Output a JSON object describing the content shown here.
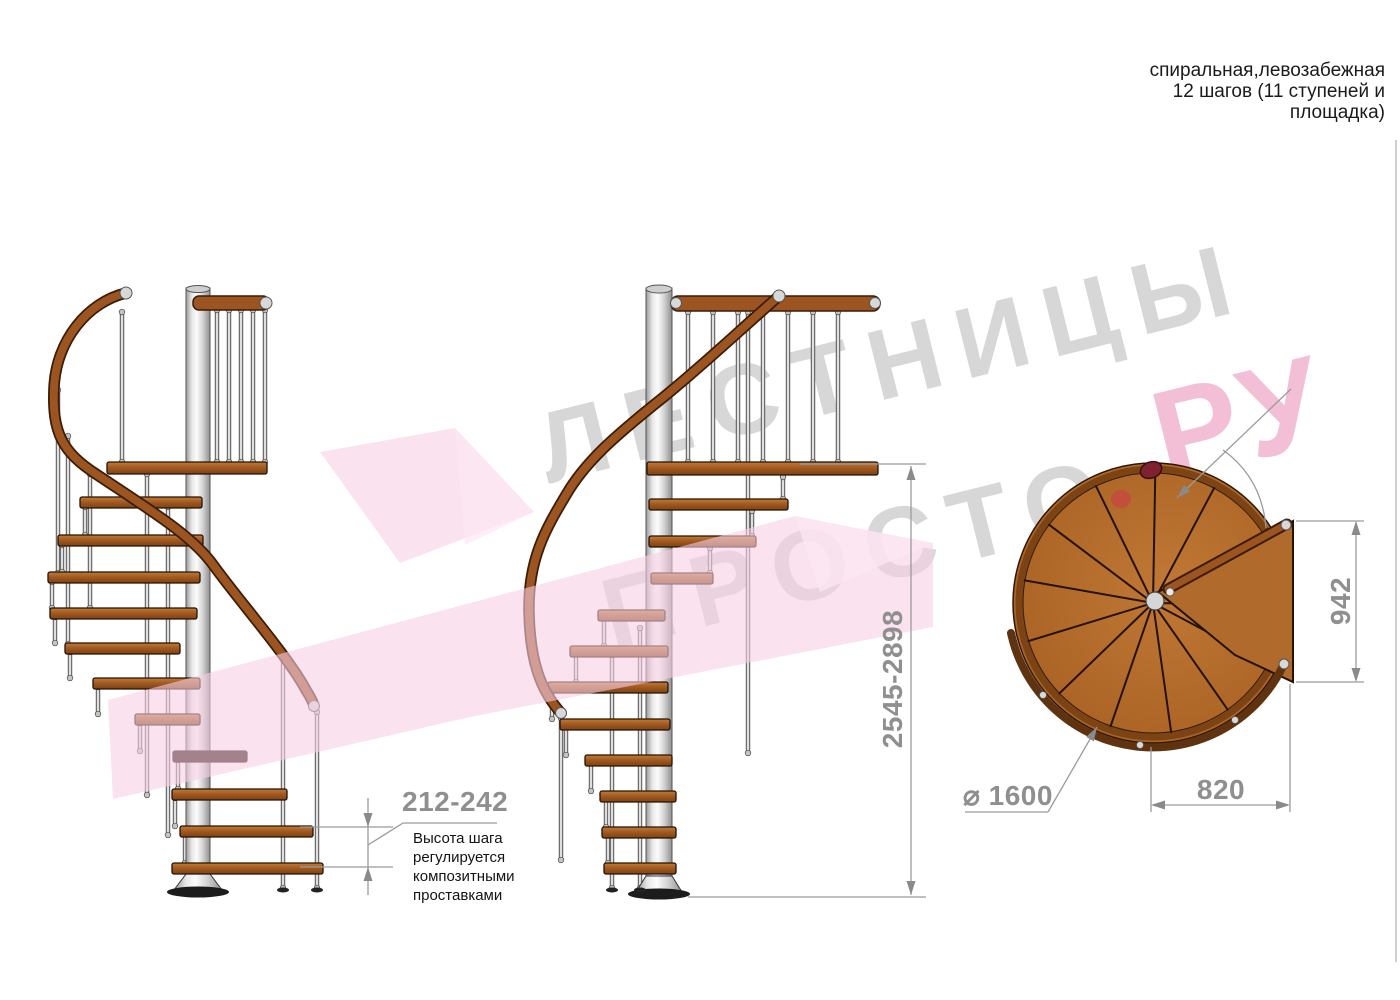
{
  "header": {
    "note": "спиральная,левозабежная\n12 шагов (11 ступеней и\nплощадка)"
  },
  "annotations": {
    "step_height_dim": "212-242",
    "step_height_note": "Высота шага\nрегулируется\nкомпозитными\nпроставками",
    "total_height_dim": "2545-2898",
    "platform_depth_dim": "942",
    "platform_length_dim": "820",
    "diameter_dim": "⌀ 1600"
  },
  "watermark": {
    "line1": "ЛЕСТНИЦЫ",
    "line2": "ПРОСТО",
    "dot": ".",
    "suffix": "РУ"
  },
  "colors": {
    "wood": "#9c5420",
    "wood_dark": "#3a1c08",
    "metal": "#d9d9d9",
    "dimension_gray": "#8f8f8f",
    "watermark_gray": "#d7d7d7",
    "watermark_pink": "#f2bfd6",
    "accent_red": "#d84a5e"
  }
}
